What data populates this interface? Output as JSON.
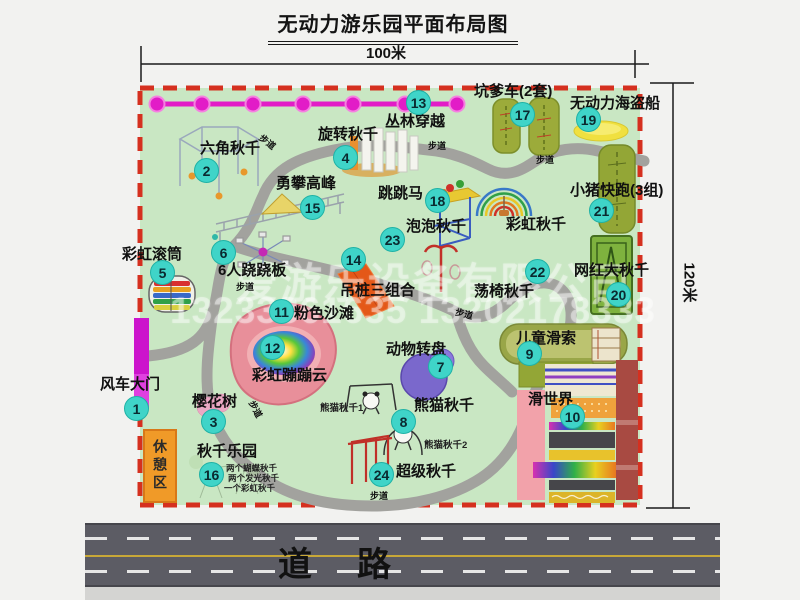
{
  "title": "无动力游乐园平面布局图",
  "dimensions": {
    "width": "100米",
    "height": "120米"
  },
  "park": {
    "attractions": [
      {
        "num": "1",
        "name": "风车大门"
      },
      {
        "num": "2",
        "name": "六角秋千"
      },
      {
        "num": "3",
        "name": "樱花树"
      },
      {
        "num": "4",
        "name": "旋转秋千"
      },
      {
        "num": "5",
        "name": "彩虹滚筒"
      },
      {
        "num": "6",
        "name": "6人跷跷板"
      },
      {
        "num": "7",
        "name": "动物转盘"
      },
      {
        "num": "8",
        "name": "熊猫秋千"
      },
      {
        "num": "9",
        "name": "儿童滑索"
      },
      {
        "num": "10",
        "name": "滑世界"
      },
      {
        "num": "11",
        "name": "粉色沙滩"
      },
      {
        "num": "12",
        "name": "彩虹蹦蹦云"
      },
      {
        "num": "13",
        "name": "丛林穿越"
      },
      {
        "num": "14",
        "name": "吊桩三组合"
      },
      {
        "num": "15",
        "name": "勇攀高峰"
      },
      {
        "num": "16",
        "name": "秋千乐园"
      },
      {
        "num": "17",
        "name": "坑爹车(2套)"
      },
      {
        "num": "18",
        "name": "跳跳马"
      },
      {
        "num": "19",
        "name": "无动力海盗船"
      },
      {
        "num": "20",
        "name": "网红大秋千"
      },
      {
        "num": "21",
        "name": "小猪快跑(3组)"
      },
      {
        "num": "22",
        "name": "荡椅秋千"
      },
      {
        "num": "23",
        "name": "泡泡秋千"
      },
      {
        "num": "24",
        "name": "超级秋千"
      }
    ],
    "rainbow_swing_label": "彩虹秋千",
    "rest_area_label": "休憩区",
    "walkway_label": "步道",
    "swing_park_details": [
      "两个蝴蝶秋千",
      "两个发光秋千",
      "一个彩虹秋千"
    ],
    "panda_swing_sub": [
      "熊猫秋千1",
      "熊猫秋千2"
    ]
  },
  "road": {
    "label": "道路"
  },
  "watermark": {
    "company": "爱游乐设备有限公司",
    "phone": "13233861635 13202178333"
  },
  "colors": {
    "park_green": "#c9e7c3",
    "border_red": "#d5301f",
    "zipline_magenta": "#e21cc7",
    "marker_teal": "#3fd4c8",
    "road_gray": "#5c5c64",
    "rest_area_orange": "#f09a28",
    "gate_magenta": "#cc14cc"
  }
}
